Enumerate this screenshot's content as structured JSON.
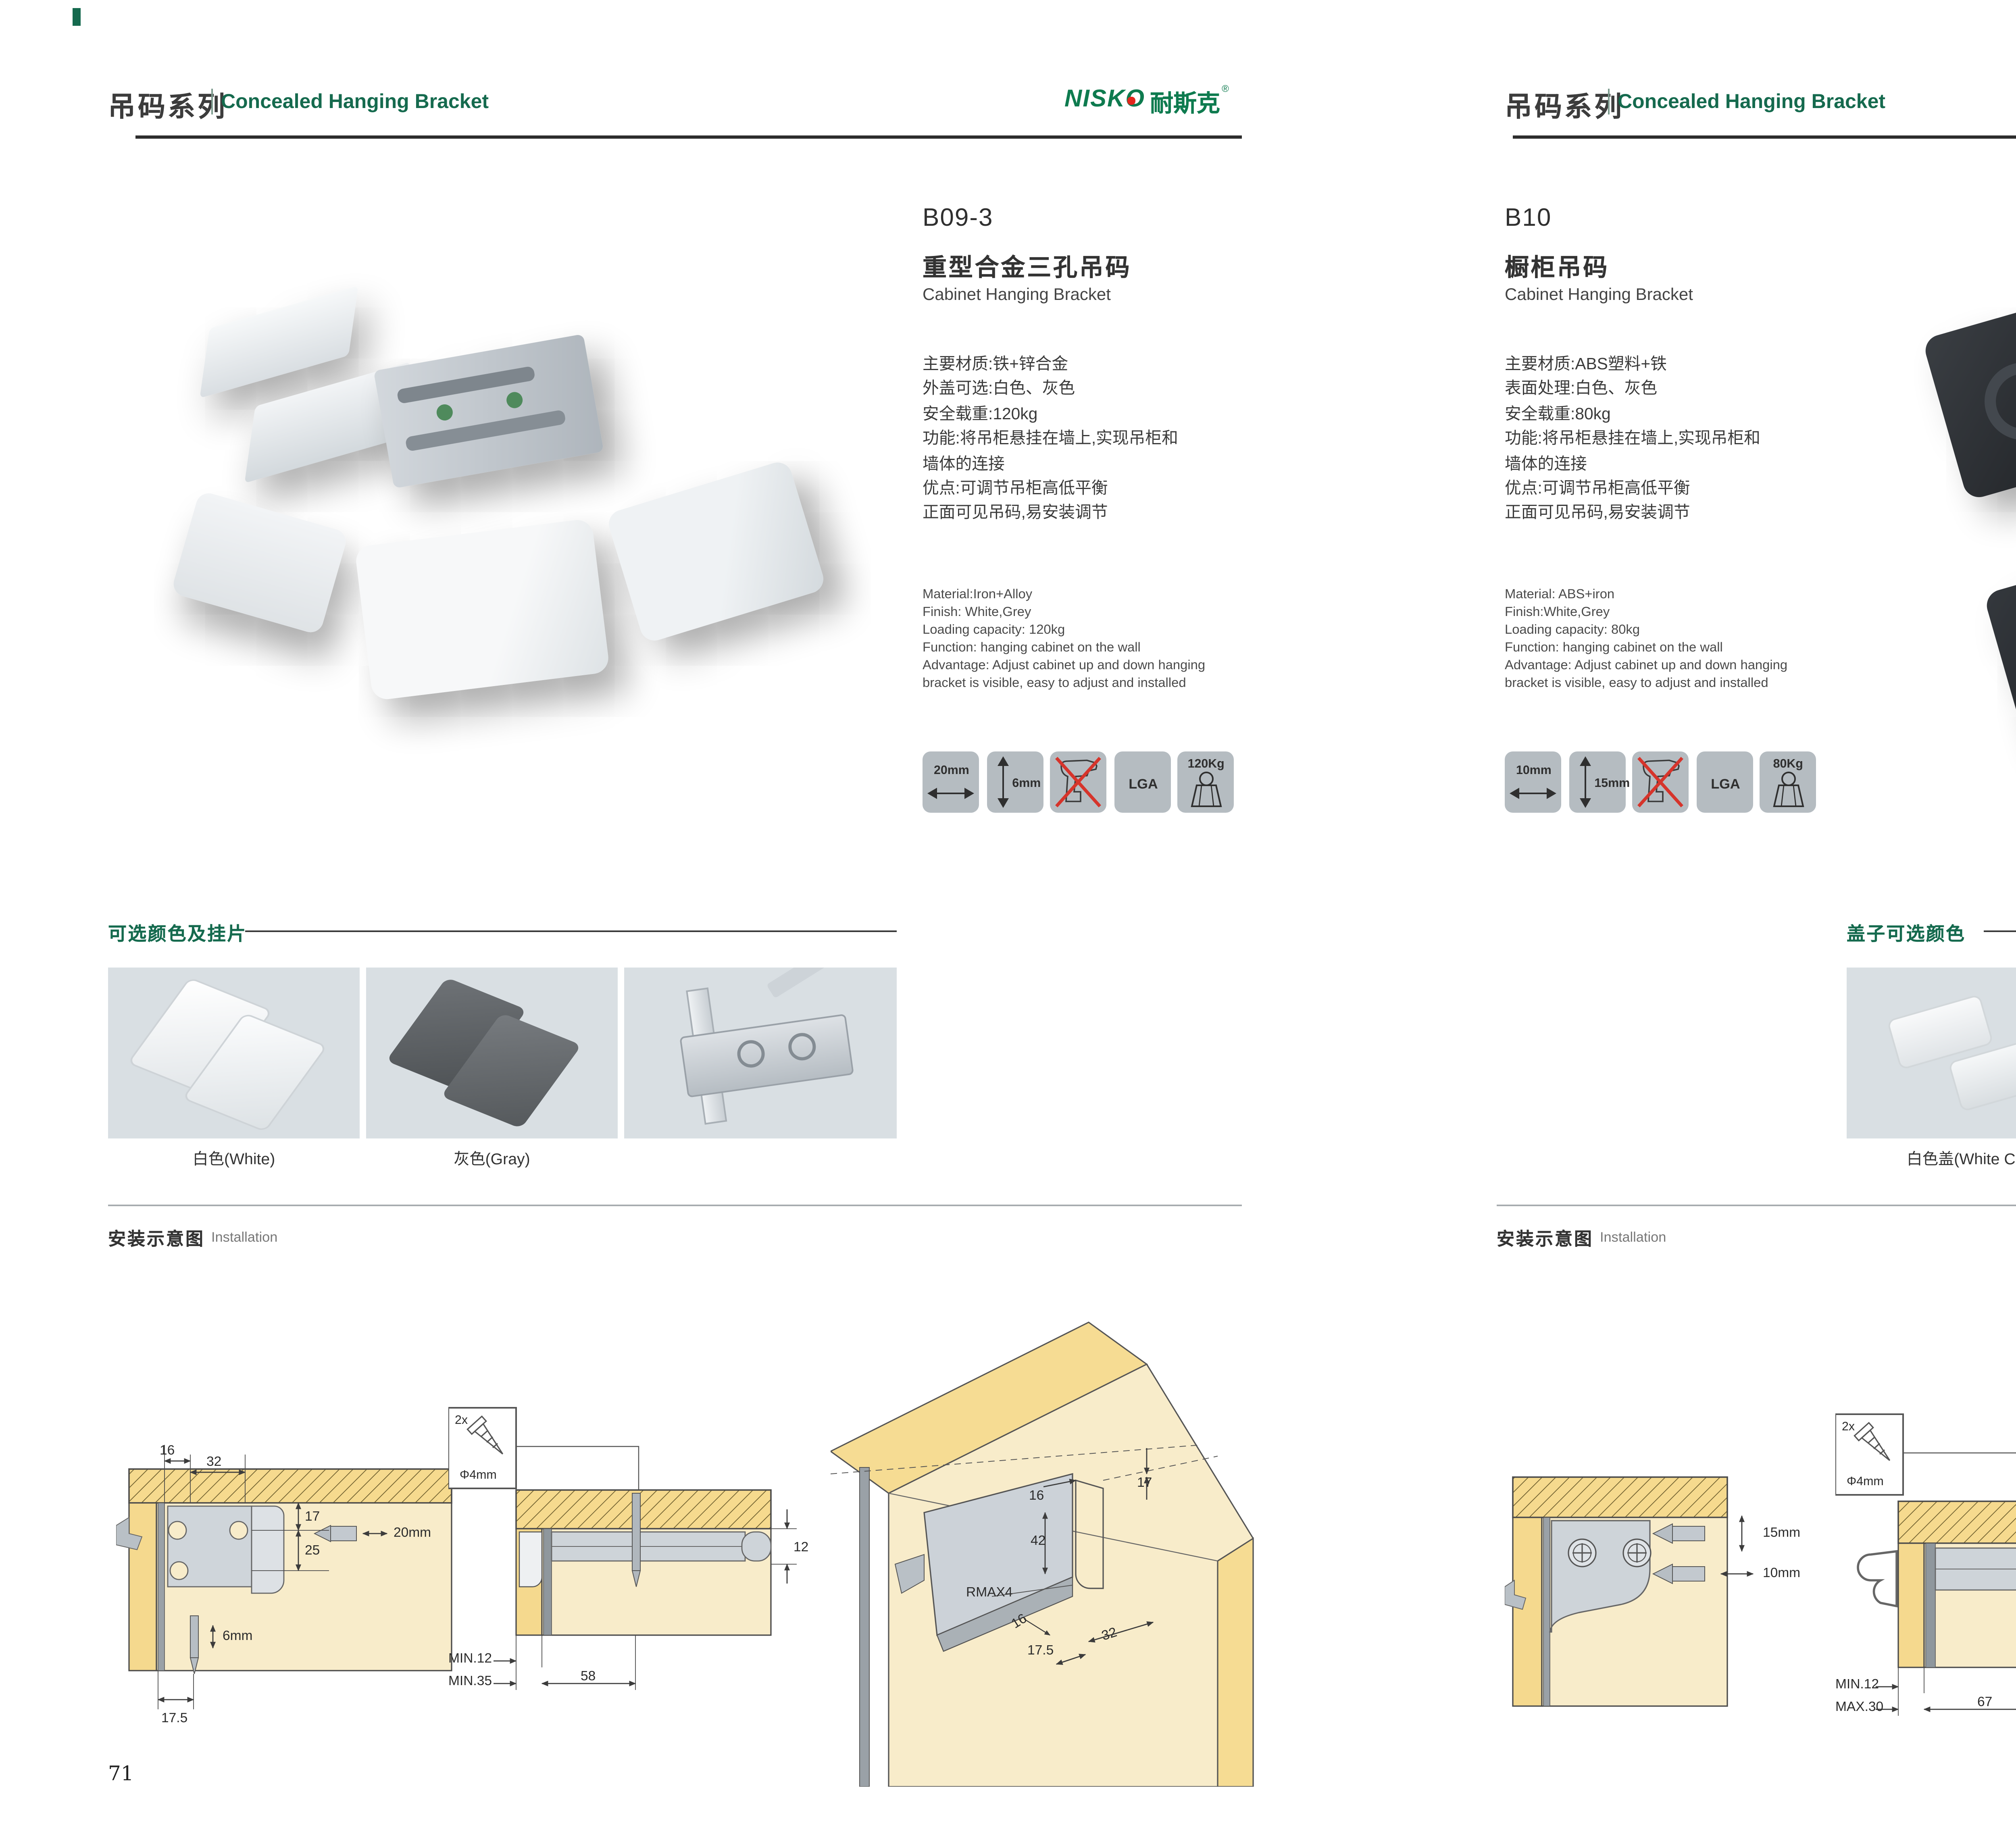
{
  "meta": {
    "accent_green": "#156a4e",
    "logo_green": "#0e7b4f",
    "logo_red": "#e3261d",
    "photo_bg": "#4e5765"
  },
  "header": {
    "series_cn": "吊码系列",
    "series_en": "Concealed Hanging Bracket",
    "logo_latin": "NISKO",
    "logo_cn": "耐斯克",
    "logo_reg": "®"
  },
  "sections": {
    "install_cn": "安装示意图",
    "install_en": "Installation"
  },
  "left": {
    "page_number": "71",
    "code": "B09-3",
    "name_cn": "重型合金三孔吊码",
    "name_en": "Cabinet Hanging Bracket",
    "specs_cn": [
      "主要材质:铁+锌合金",
      "外盖可选:白色、灰色",
      "安全载重:120kg",
      "功能:将吊柜悬挂在墙上,实现吊柜和",
      "墙体的连接",
      "优点:可调节吊柜高低平衡",
      "正面可见吊码,易安装调节"
    ],
    "specs_en": [
      "Material:Iron+Alloy",
      "Finish: White,Grey",
      "Loading capacity: 120kg",
      "Function: hanging cabinet on the wall",
      "Advantage: Adjust cabinet up and down hanging",
      "bracket is visible, easy to adjust and installed"
    ],
    "icons": {
      "width_label": "20mm",
      "height_label": "6mm",
      "cert_label": "LGA",
      "load_label": "120Kg"
    },
    "colors_title": "可选颜色及挂片",
    "captions": [
      "白色(White)",
      "灰色(Gray)"
    ],
    "d1": {
      "a": "16",
      "b": "32",
      "c": "17",
      "d": "25",
      "e": "20mm",
      "f": "6mm",
      "g": "17.5"
    },
    "d2": {
      "qty": "2x",
      "dia": "Φ4mm",
      "a": "12",
      "b": "MIN.12",
      "c": "MIN.35",
      "d": "58"
    },
    "d3": {
      "a": "17",
      "b": "16",
      "c": "42",
      "d": "RMAX4",
      "e": "16",
      "f": "32",
      "g": "17.5"
    }
  },
  "right": {
    "page_number": "72",
    "code": "B10",
    "name_cn": "橱柜吊码",
    "name_en": "Cabinet Hanging Bracket",
    "specs_cn": [
      "主要材质:ABS塑料+铁",
      "表面处理:白色、灰色",
      "安全载重:80kg",
      "功能:将吊柜悬挂在墙上,实现吊柜和",
      "墙体的连接",
      "优点:可调节吊柜高低平衡",
      "正面可见吊码,易安装调节"
    ],
    "specs_en": [
      "Material: ABS+iron",
      "Finish:White,Grey",
      "Loading capacity: 80kg",
      "Function: hanging cabinet on the wall",
      "Advantage: Adjust cabinet up and down hanging",
      "bracket is visible, easy to adjust and installed"
    ],
    "icons": {
      "width_label": "10mm",
      "height_label": "15mm",
      "cert_label": "LGA",
      "load_label": "80Kg"
    },
    "colors_title": "盖子可选颜色",
    "captions": [
      "白色盖(White Cap)",
      "灰色盖(Gray Cap)"
    ],
    "d1": {
      "a": "15mm",
      "b": "10mm"
    },
    "d2": {
      "qty": "2x",
      "dia": "Φ4mm",
      "a": "18",
      "b": "MIN.12",
      "c": "MAX.30",
      "d": "67"
    },
    "d3": {
      "a": "13",
      "b": "42",
      "c": "RMAX4",
      "d": "19",
      "e": "17",
      "f": "32"
    }
  }
}
